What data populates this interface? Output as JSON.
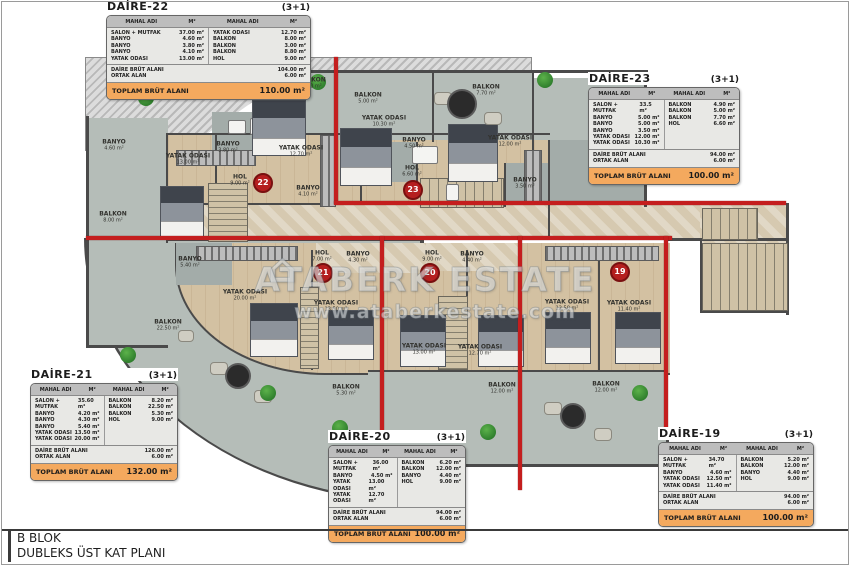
{
  "sheet": {
    "block_label": "B BLOK",
    "plan_label": "DUBLEKS ÜST KAT PLANI"
  },
  "watermark": {
    "house_icon": "⌂",
    "brand": "ATABERK ESTATE",
    "url": "www.ataberkestate.com"
  },
  "table_header": {
    "room_col": "MAHAL ADI",
    "area_col": "M²"
  },
  "units": [
    {
      "id": "daire-22",
      "name": "DAİRE-22",
      "type": "(3+1)",
      "rows_left": [
        [
          "SALON + MUTFAK",
          "37.00 m²"
        ],
        [
          "BANYO",
          "4.60 m²"
        ],
        [
          "BANYO",
          "3.80 m²"
        ],
        [
          "BANYO",
          "4.10 m²"
        ],
        [
          "YATAK ODASI",
          "13.00 m²"
        ]
      ],
      "rows_right": [
        [
          "YATAK ODASI",
          "12.70 m²"
        ],
        [
          "BALKON",
          "8.00 m²"
        ],
        [
          "BALKON",
          "3.00 m²"
        ],
        [
          "BALKON",
          "8.80 m²"
        ],
        [
          "HOL",
          "9.00 m²"
        ]
      ],
      "summary": [
        [
          "DAİRE BRÜT ALANI",
          "104.00 m²"
        ],
        [
          "ORTAK ALAN",
          "6.00 m²"
        ]
      ],
      "total_label": "TOPLAM BRÜT ALANI",
      "total_value": "110.00 m²"
    },
    {
      "id": "daire-23",
      "name": "DAİRE-23",
      "type": "(3+1)",
      "rows_left": [
        [
          "SALON + MUTFAK",
          "33.5 m²"
        ],
        [
          "BANYO",
          "5.00 m²"
        ],
        [
          "BANYO",
          "5.00 m²"
        ],
        [
          "BANYO",
          "3.50 m²"
        ],
        [
          "YATAK ODASI",
          "12.00 m²"
        ],
        [
          "YATAK ODASI",
          "10.30 m²"
        ]
      ],
      "rows_right": [
        [
          "BALKON",
          "4.90 m²"
        ],
        [
          "BALKON",
          "5.00 m²"
        ],
        [
          "BALKON",
          "7.70 m²"
        ],
        [
          "HOL",
          "6.60 m²"
        ]
      ],
      "summary": [
        [
          "DAİRE BRÜT ALANI",
          "94.00 m²"
        ],
        [
          "ORTAK ALAN",
          "6.00 m²"
        ]
      ],
      "total_label": "TOPLAM BRÜT ALANI",
      "total_value": "100.00 m²"
    },
    {
      "id": "daire-21",
      "name": "DAİRE-21",
      "type": "(3+1)",
      "rows_left": [
        [
          "SALON + MUTFAK",
          "35.60 m²"
        ],
        [
          "BANYO",
          "4.20 m²"
        ],
        [
          "BANYO",
          "4.30 m²"
        ],
        [
          "BANYO",
          "5.40 m²"
        ],
        [
          "YATAK ODASI",
          "13.50 m²"
        ],
        [
          "YATAK ODASI",
          "20.00 m²"
        ]
      ],
      "rows_right": [
        [
          "BALKON",
          "8.20 m²"
        ],
        [
          "BALKON",
          "22.50 m²"
        ],
        [
          "BALKON",
          "5.30 m²"
        ],
        [
          "HOL",
          "9.00 m²"
        ]
      ],
      "summary": [
        [
          "DAİRE BRÜT ALANI",
          "126.00 m²"
        ],
        [
          "ORTAK ALAN",
          "6.00 m²"
        ]
      ],
      "total_label": "TOPLAM BRÜT ALANI",
      "total_value": "132.00 m²"
    },
    {
      "id": "daire-20",
      "name": "DAİRE-20",
      "type": "(3+1)",
      "rows_left": [
        [
          "SALON + MUTFAK",
          "36.00 m²"
        ],
        [
          "BANYO",
          "4.50 m²"
        ],
        [
          "YATAK ODASI",
          "13.00 m²"
        ],
        [
          "YATAK ODASI",
          "12.70 m²"
        ]
      ],
      "rows_right": [
        [
          "BALKON",
          "6.20 m²"
        ],
        [
          "BALKON",
          "12.00 m²"
        ],
        [
          "BANYO",
          "4.40 m²"
        ],
        [
          "HOL",
          "9.00 m²"
        ]
      ],
      "summary": [
        [
          "DAİRE BRÜT ALANI",
          "94.00 m²"
        ],
        [
          "ORTAK ALAN",
          "6.00 m²"
        ]
      ],
      "total_label": "TOPLAM BRÜT ALANI",
      "total_value": "100.00 m²"
    },
    {
      "id": "daire-19",
      "name": "DAİRE-19",
      "type": "(3+1)",
      "rows_left": [
        [
          "SALON + MUTFAK",
          "34.70 m²"
        ],
        [
          "BANYO",
          "4.60 m²"
        ],
        [
          "YATAK ODASI",
          "12.50 m²"
        ],
        [
          "YATAK ODASI",
          "11.40 m²"
        ]
      ],
      "rows_right": [
        [
          "BALKON",
          "5.20 m²"
        ],
        [
          "BALKON",
          "12.00 m²"
        ],
        [
          "BANYO",
          "4.40 m²"
        ],
        [
          "HOL",
          "9.00 m²"
        ]
      ],
      "summary": [
        [
          "DAİRE BRÜT ALANI",
          "94.00 m²"
        ],
        [
          "ORTAK ALAN",
          "6.00 m²"
        ]
      ],
      "total_label": "TOPLAM BRÜT ALANI",
      "total_value": "100.00 m²"
    }
  ],
  "plan": {
    "badges": [
      {
        "unit": "22",
        "x": 263,
        "y": 183
      },
      {
        "unit": "23",
        "x": 413,
        "y": 190
      },
      {
        "unit": "21",
        "x": 323,
        "y": 273
      },
      {
        "unit": "20",
        "x": 430,
        "y": 273
      },
      {
        "unit": "19",
        "x": 620,
        "y": 272
      }
    ],
    "labels": [
      {
        "name": "BALKON",
        "area": "8.00 m²",
        "x": 113,
        "y": 218
      },
      {
        "name": "BANYO",
        "area": "4.60 m²",
        "x": 114,
        "y": 146
      },
      {
        "name": "YATAK ODASI",
        "area": "13.00 m²",
        "x": 188,
        "y": 160
      },
      {
        "name": "BANYO",
        "area": "3.80 m²",
        "x": 228,
        "y": 148
      },
      {
        "name": "YATAK ODASI",
        "area": "12.70 m²",
        "x": 301,
        "y": 152
      },
      {
        "name": "HOL",
        "area": "9.00 m²",
        "x": 240,
        "y": 181
      },
      {
        "name": "BANYO",
        "area": "4.10 m²",
        "x": 308,
        "y": 192
      },
      {
        "name": "BALKON",
        "area": "3.00 m²",
        "x": 312,
        "y": 84
      },
      {
        "name": "BALKON",
        "area": "5.00 m²",
        "x": 368,
        "y": 99
      },
      {
        "name": "BALKON",
        "area": "7.70 m²",
        "x": 486,
        "y": 91
      },
      {
        "name": "YATAK ODASI",
        "area": "10.30 m²",
        "x": 384,
        "y": 122
      },
      {
        "name": "BANYO",
        "area": "4.50 m²",
        "x": 414,
        "y": 144
      },
      {
        "name": "YATAK ODASI",
        "area": "12.00 m²",
        "x": 510,
        "y": 142
      },
      {
        "name": "HOL",
        "area": "6.60 m²",
        "x": 412,
        "y": 172
      },
      {
        "name": "BANYO",
        "area": "3.50 m²",
        "x": 525,
        "y": 184
      },
      {
        "name": "BANYO",
        "area": "5.40 m²",
        "x": 190,
        "y": 263
      },
      {
        "name": "HOL",
        "area": "7.00 m²",
        "x": 322,
        "y": 257
      },
      {
        "name": "BANYO",
        "area": "4.30 m²",
        "x": 358,
        "y": 258
      },
      {
        "name": "HOL",
        "area": "9.00 m²",
        "x": 432,
        "y": 257
      },
      {
        "name": "BANYO",
        "area": "4.40 m²",
        "x": 472,
        "y": 258
      },
      {
        "name": "YATAK ODASI",
        "area": "20.00 m²",
        "x": 245,
        "y": 296
      },
      {
        "name": "YATAK ODASI",
        "area": "13.50 m²",
        "x": 336,
        "y": 307
      },
      {
        "name": "BALKON",
        "area": "22.50 m²",
        "x": 168,
        "y": 326
      },
      {
        "name": "BALKON",
        "area": "5.30 m²",
        "x": 346,
        "y": 391
      },
      {
        "name": "YATAK ODASI",
        "area": "13.00 m²",
        "x": 424,
        "y": 350
      },
      {
        "name": "YATAK ODASI",
        "area": "12.70 m²",
        "x": 480,
        "y": 351
      },
      {
        "name": "YATAK ODASI",
        "area": "12.50 m²",
        "x": 567,
        "y": 306
      },
      {
        "name": "YATAK ODASI",
        "area": "11.40 m²",
        "x": 629,
        "y": 307
      },
      {
        "name": "BALKON",
        "area": "12.00 m²",
        "x": 502,
        "y": 389
      },
      {
        "name": "BALKON",
        "area": "12.00 m²",
        "x": 606,
        "y": 388
      }
    ]
  }
}
